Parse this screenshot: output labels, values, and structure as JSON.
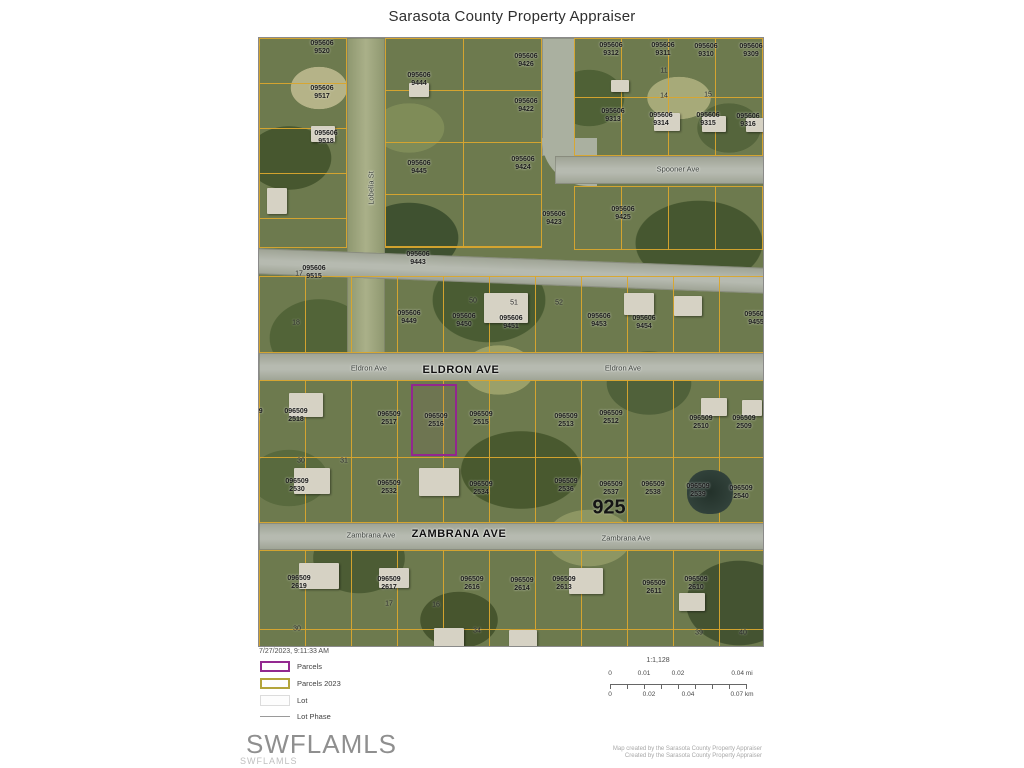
{
  "title": "Sarasota County Property Appraiser",
  "timestamp": "7/27/2023, 9:11:33 AM",
  "watermark": {
    "large": "SWFLAMLS",
    "small": "SWFLAMLS"
  },
  "attribution": [
    "Map created by the Sarasota County Property Appraiser",
    "Created by the Sarasota County Property Appraiser"
  ],
  "legend": {
    "items": [
      {
        "label": "Parcels",
        "color": "#92278f"
      },
      {
        "label": "Parcels 2023",
        "color": "#b3a43b"
      },
      {
        "label": "Lot",
        "color": "#dcdcdc"
      },
      {
        "label": "Lot Phase",
        "color": "#9a9a9a"
      }
    ]
  },
  "scale": {
    "ratio": "1:1,128",
    "mi_labels": [
      "0",
      "0.01",
      "0.02",
      "0.04 mi"
    ],
    "km_labels": [
      "0",
      "0.02",
      "0.04",
      "0.07 km"
    ]
  },
  "map": {
    "highlight_color": "#92278f",
    "parcel_line_color": "#d9a62e",
    "plat_number": {
      "text": "925",
      "x": 350,
      "y": 470
    },
    "streets": [
      {
        "text": "Lobelia St",
        "x": 112,
        "y": 150,
        "cls": "small vertical"
      },
      {
        "text": "Spooner Ave",
        "x": 419,
        "y": 131,
        "cls": "small"
      },
      {
        "text": "Eldron Ave",
        "x": 110,
        "y": 330,
        "cls": "small"
      },
      {
        "text": "ELDRON AVE",
        "x": 202,
        "y": 332,
        "cls": "big"
      },
      {
        "text": "Eldron Ave",
        "x": 364,
        "y": 330,
        "cls": "small"
      },
      {
        "text": "Zambrana Ave",
        "x": 112,
        "y": 497,
        "cls": "small"
      },
      {
        "text": "ZAMBRANA AVE",
        "x": 200,
        "y": 496,
        "cls": "big"
      },
      {
        "text": "Zambrana Ave",
        "x": 367,
        "y": 500,
        "cls": "small"
      }
    ],
    "parcel_labels": [
      {
        "a": "095606",
        "b": "9525",
        "x": -12,
        "y": 11
      },
      {
        "a": "095606",
        "b": "9520",
        "x": 63,
        "y": 10
      },
      {
        "a": "095606",
        "b": "9517",
        "x": 63,
        "y": 55
      },
      {
        "a": "095606",
        "b": "9518",
        "x": 67,
        "y": 100
      },
      {
        "a": "095606",
        "b": "9515",
        "x": 55,
        "y": 235
      },
      {
        "a": "095606",
        "b": "9444",
        "x": 160,
        "y": 42
      },
      {
        "a": "095606",
        "b": "9445",
        "x": 160,
        "y": 130
      },
      {
        "a": "095606",
        "b": "9426",
        "x": 267,
        "y": 23
      },
      {
        "a": "095606",
        "b": "9422",
        "x": 267,
        "y": 68
      },
      {
        "a": "095606",
        "b": "9424",
        "x": 264,
        "y": 126
      },
      {
        "a": "095606",
        "b": "9423",
        "x": 295,
        "y": 181
      },
      {
        "a": "095606",
        "b": "9425",
        "x": 364,
        "y": 176
      },
      {
        "a": "095606",
        "b": "9312",
        "x": 352,
        "y": 12
      },
      {
        "a": "095606",
        "b": "9311",
        "x": 404,
        "y": 12
      },
      {
        "a": "095606",
        "b": "9310",
        "x": 447,
        "y": 13
      },
      {
        "a": "095606",
        "b": "9309",
        "x": 492,
        "y": 13
      },
      {
        "a": "095606",
        "b": "9313",
        "x": 354,
        "y": 78
      },
      {
        "a": "095606",
        "b": "9314",
        "x": 402,
        "y": 82
      },
      {
        "a": "095606",
        "b": "9315",
        "x": 449,
        "y": 82
      },
      {
        "a": "095606",
        "b": "9316",
        "x": 489,
        "y": 83
      },
      {
        "a": "095606",
        "b": "9443",
        "x": 159,
        "y": 221
      },
      {
        "a": "095606",
        "b": "9449",
        "x": 150,
        "y": 280
      },
      {
        "a": "095606",
        "b": "9450",
        "x": 205,
        "y": 283
      },
      {
        "a": "095606",
        "b": "9451",
        "x": 252,
        "y": 285
      },
      {
        "a": "095606",
        "b": "9453",
        "x": 340,
        "y": 283
      },
      {
        "a": "095606",
        "b": "9454",
        "x": 385,
        "y": 285
      },
      {
        "a": "095606",
        "b": "9455",
        "x": 497,
        "y": 281
      },
      {
        "a": "096509",
        "b": "2520",
        "x": -8,
        "y": 378
      },
      {
        "a": "096509",
        "b": "2518",
        "x": 37,
        "y": 378
      },
      {
        "a": "096509",
        "b": "2517",
        "x": 130,
        "y": 381
      },
      {
        "a": "096509",
        "b": "2516",
        "x": 177,
        "y": 383
      },
      {
        "a": "096509",
        "b": "2515",
        "x": 222,
        "y": 381
      },
      {
        "a": "096509",
        "b": "2513",
        "x": 307,
        "y": 383
      },
      {
        "a": "096509",
        "b": "2512",
        "x": 352,
        "y": 380
      },
      {
        "a": "096509",
        "b": "2510",
        "x": 442,
        "y": 385
      },
      {
        "a": "096509",
        "b": "2509",
        "x": 485,
        "y": 385
      },
      {
        "a": "096509",
        "b": "2530",
        "x": 38,
        "y": 448
      },
      {
        "a": "096509",
        "b": "2532",
        "x": 130,
        "y": 450
      },
      {
        "a": "096509",
        "b": "2534",
        "x": 222,
        "y": 451
      },
      {
        "a": "096509",
        "b": "2536",
        "x": 307,
        "y": 448
      },
      {
        "a": "096509",
        "b": "2537",
        "x": 352,
        "y": 451
      },
      {
        "a": "096509",
        "b": "2538",
        "x": 394,
        "y": 451
      },
      {
        "a": "096509",
        "b": "2539",
        "x": 439,
        "y": 453
      },
      {
        "a": "096509",
        "b": "2540",
        "x": 482,
        "y": 455
      },
      {
        "a": "096509",
        "b": "2619",
        "x": 40,
        "y": 545
      },
      {
        "a": "096509",
        "b": "2617",
        "x": 130,
        "y": 546
      },
      {
        "a": "096509",
        "b": "2616",
        "x": 213,
        "y": 546
      },
      {
        "a": "096509",
        "b": "2614",
        "x": 263,
        "y": 547
      },
      {
        "a": "096509",
        "b": "2613",
        "x": 305,
        "y": 546
      },
      {
        "a": "096509",
        "b": "2611",
        "x": 395,
        "y": 550
      },
      {
        "a": "096509",
        "b": "2610",
        "x": 437,
        "y": 546
      }
    ],
    "lot_numbers": [
      {
        "t": "11",
        "x": 405,
        "y": 33
      },
      {
        "t": "14",
        "x": 405,
        "y": 58
      },
      {
        "t": "15",
        "x": 449,
        "y": 57
      },
      {
        "t": "17",
        "x": 40,
        "y": 236
      },
      {
        "t": "18",
        "x": 37,
        "y": 285
      },
      {
        "t": "50",
        "x": 214,
        "y": 263
      },
      {
        "t": "51",
        "x": 255,
        "y": 265
      },
      {
        "t": "52",
        "x": 300,
        "y": 265
      },
      {
        "t": "30",
        "x": 42,
        "y": 423
      },
      {
        "t": "31",
        "x": 85,
        "y": 423
      },
      {
        "t": "17",
        "x": 130,
        "y": 566
      },
      {
        "t": "16",
        "x": 177,
        "y": 567
      },
      {
        "t": "34",
        "x": 218,
        "y": 593
      },
      {
        "t": "39",
        "x": 440,
        "y": 595
      },
      {
        "t": "40",
        "x": 484,
        "y": 595
      },
      {
        "t": "30",
        "x": 38,
        "y": 591
      }
    ]
  }
}
